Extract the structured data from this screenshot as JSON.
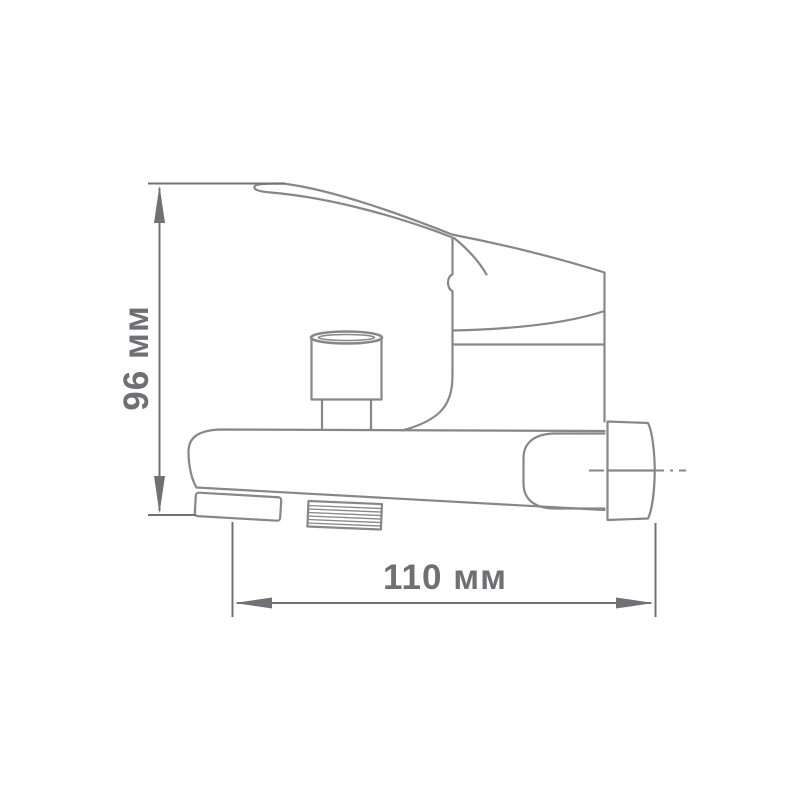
{
  "page": {
    "width": 800,
    "height": 800,
    "background": "#ffffff"
  },
  "drawing": {
    "kind": "technical-dimension-diagram",
    "subject": "wall-mounted-single-lever-bath-faucet-side-view",
    "colors": {
      "line_color": "#87878b",
      "dim_color": "#717175",
      "text_color": "#6f6f74",
      "bg_color": "#ffffff"
    },
    "dimensions": {
      "height": {
        "label": "96 мм",
        "value": 96,
        "unit": "мм",
        "orientation": "vertical"
      },
      "width": {
        "label": "110 мм",
        "value": 110,
        "unit": "мм",
        "orientation": "horizontal"
      }
    },
    "parts": [
      "handle-lever",
      "cartridge-ring",
      "faucet-body",
      "diverter-knob",
      "spout-barrel",
      "spout-tip",
      "shower-outlet-thread",
      "connector-sleeve",
      "wall-connector-nut",
      "center-line"
    ]
  }
}
